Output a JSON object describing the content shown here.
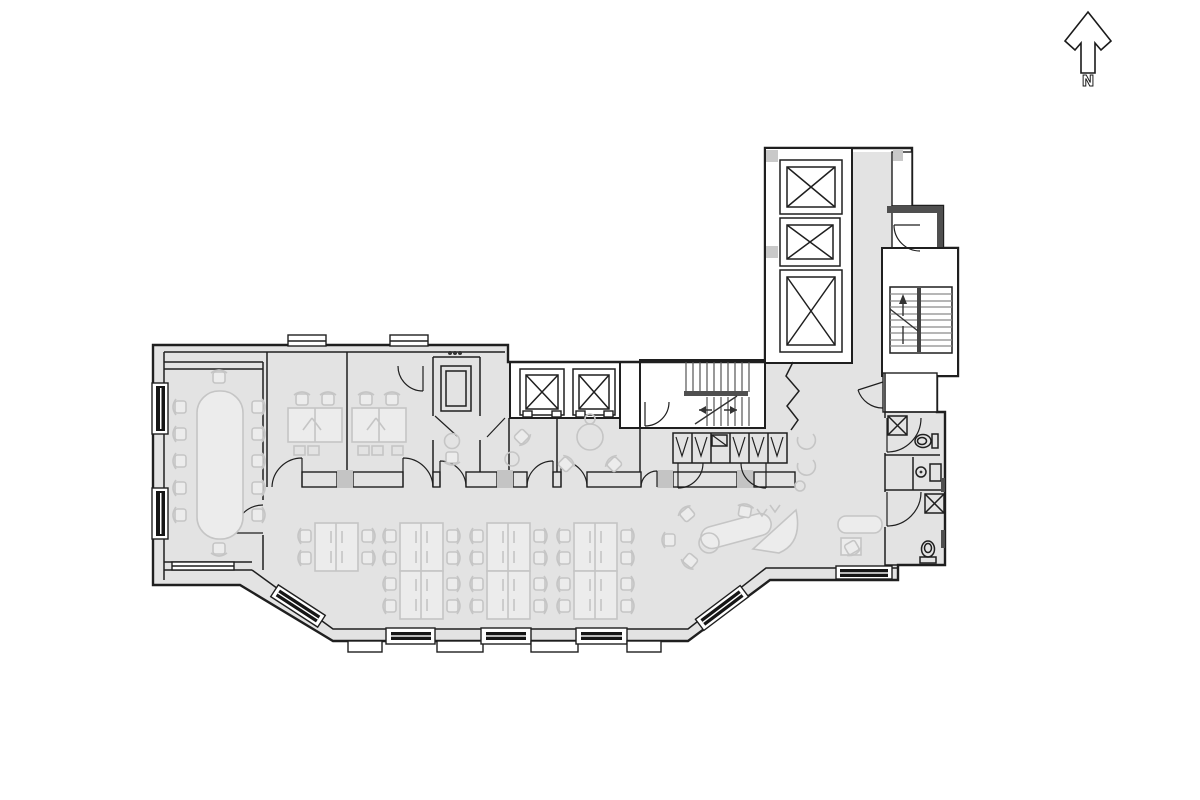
{
  "north_indicator": {
    "label": "N"
  },
  "colors": {
    "floor": "#e3e3e3",
    "room": "#ffffff",
    "wall": "#1f1f1f",
    "wall_heavy": "#4f4f4f",
    "furn": "#c5c5c5",
    "furn_fill": "#ececec",
    "column": "#c4c4c4",
    "window": "#161616",
    "marker": "#c9c9c9"
  },
  "plan": {
    "kind": "office-floor-plan",
    "conference_room": {
      "seats": 12
    },
    "private_offices": 2,
    "meeting_rooms": 2,
    "open_office": {
      "workstation_blocks": 7,
      "seats_per_block": 4
    },
    "elevators": {
      "upper_bank_cars": 3,
      "mid_bank_cars": 2
    },
    "stairwells": 2,
    "restrooms": {
      "count": 2,
      "fixtures": [
        "sink",
        "toilet"
      ]
    },
    "storage_cabinets": 6,
    "column_markers": 4
  }
}
